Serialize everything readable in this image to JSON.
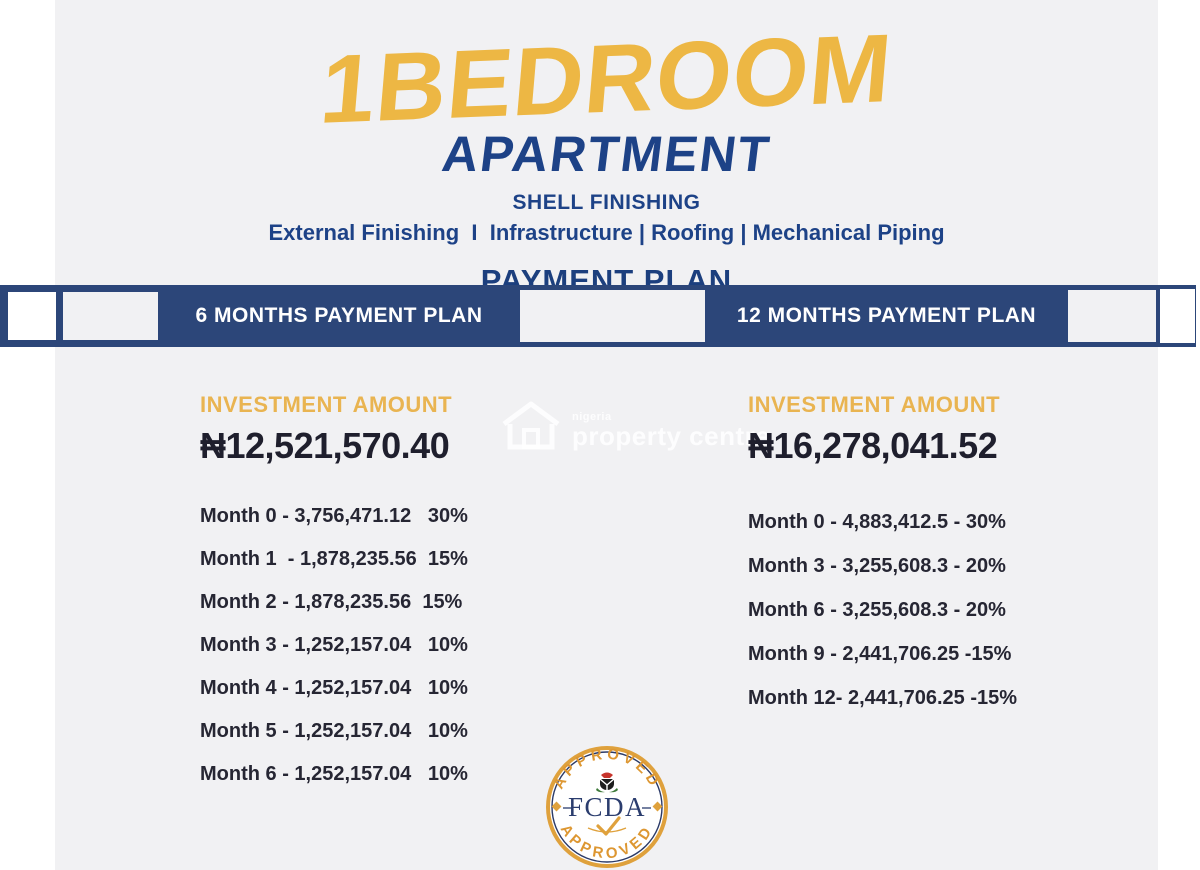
{
  "title": {
    "line1": "1BEDROOM",
    "line2": "APARTMENT"
  },
  "subtitle": {
    "finishing": "SHELL FINISHING",
    "details": "External Finishing  I  Infrastructure | Roofing | Mechanical Piping",
    "section": "PAYMENT PLAN"
  },
  "plans": [
    {
      "header": "6 MONTHS PAYMENT PLAN",
      "investment_label": "INVESTMENT AMOUNT",
      "amount": "₦12,521,570.40",
      "rows": [
        {
          "text": "Month 0 - 3,756,471.12   30%"
        },
        {
          "text": "Month 1  - 1,878,235.56  15%"
        },
        {
          "text": "Month 2 - 1,878,235.56  15%"
        },
        {
          "text": "Month 3 - 1,252,157.04   10%"
        },
        {
          "text": "Month 4 - 1,252,157.04   10%"
        },
        {
          "text": "Month 5 - 1,252,157.04   10%"
        },
        {
          "text": "Month 6 - 1,252,157.04   10%"
        }
      ]
    },
    {
      "header": "12 MONTHS PAYMENT PLAN",
      "investment_label": "INVESTMENT AMOUNT",
      "amount": "₦16,278,041.52",
      "rows": [
        {
          "text": "Month 0 - 4,883,412.5 - 30%"
        },
        {
          "text": "Month 3 - 3,255,608.3 - 20%"
        },
        {
          "text": "Month 6 - 3,255,608.3 - 20%"
        },
        {
          "text": "Month 9 - 2,441,706.25 -15%"
        },
        {
          "text": "Month 12- 2,441,706.25 -15%"
        }
      ]
    }
  ],
  "watermark": {
    "line1": "nigeria",
    "line2": "property centre"
  },
  "seal": {
    "arc_top": "APPROVED",
    "arc_bottom": "APPROVED",
    "center": "FCDA"
  },
  "colors": {
    "gold": "#EDB744",
    "navy": "#1D4287",
    "banner_blue": "#2C4679",
    "text_dark": "#262633",
    "bg_gray": "#F1F1F3",
    "seal_gold": "#DFA13C",
    "seal_text": "#DD9732",
    "seal_navy": "#2B3D6E"
  }
}
